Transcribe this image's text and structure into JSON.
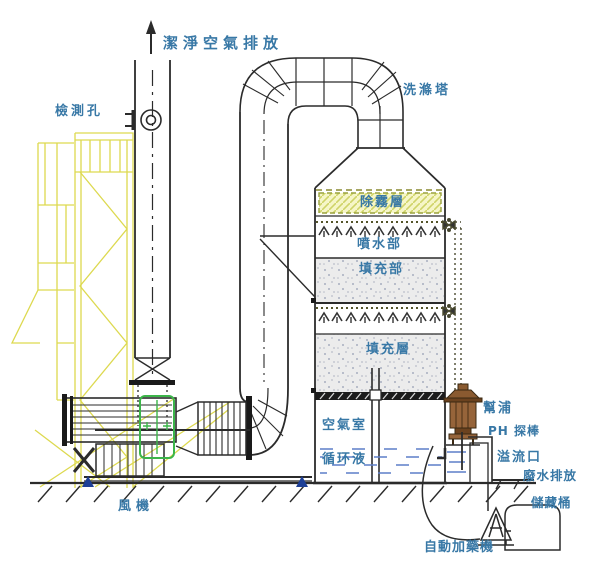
{
  "diagram_title": "洗滌塔",
  "labels": {
    "clean_air_outlet": "潔淨空氣排放",
    "inspection_port": "檢測孔",
    "scrubber_tower": "洗滌塔",
    "demister_layer": "除霧層",
    "spray_section": "噴水部",
    "packing_section": "填充部",
    "packing_layer": "填充層",
    "air_chamber": "空氣室",
    "circulating_liquid": "循环液",
    "pump": "幫浦",
    "ph_probe": "PH 探棒",
    "overflow_port": "溢流口",
    "wastewater_discharge": "廢水排放",
    "fan": "風機",
    "storage_tank": "儲藏桶",
    "auto_dosing_machine": "自動加藥機"
  },
  "colors": {
    "line": "#2b2b2b",
    "label_text": "#3878a6",
    "scaffold_yellow": "#ddd94f",
    "demister_fill": "#f6f6c8",
    "demister_hatch": "#cfd468",
    "packing_fill": "#ececec",
    "water_blue": "#5d7fc9",
    "connector_green": "#3cb54a",
    "pump_brown": "#8a5a30",
    "anchor_blue": "#1d3f96"
  }
}
